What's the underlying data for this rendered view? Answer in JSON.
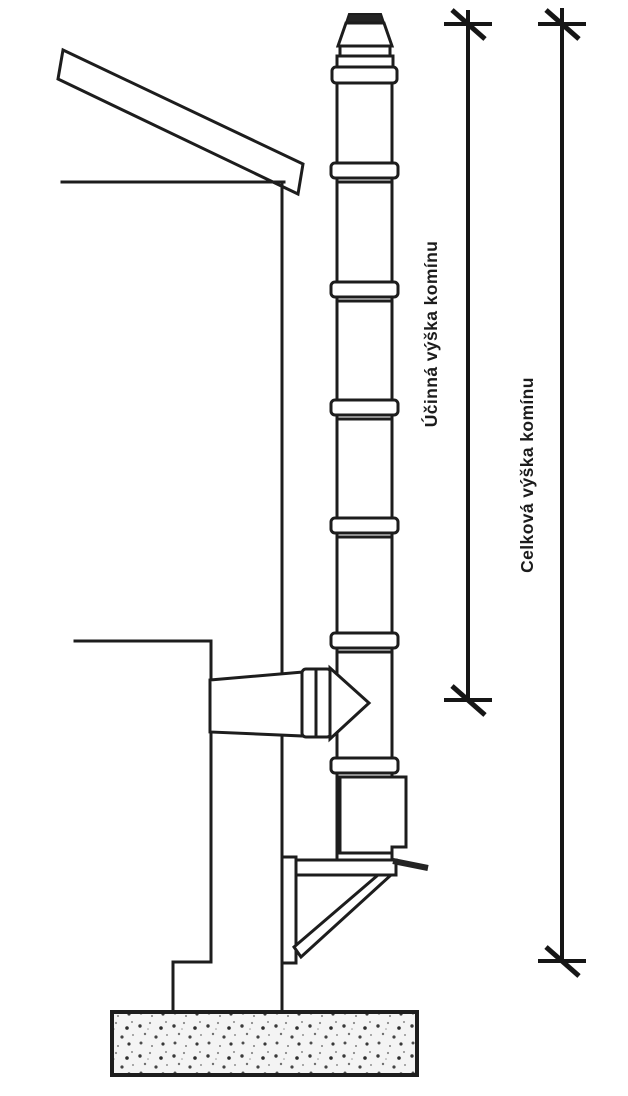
{
  "diagram": {
    "dimension_labels": {
      "effective_height": "Účinná výška komínu",
      "total_height": "Celková výška komínu"
    },
    "colors": {
      "background": "#ffffff",
      "line": "#1d1d1d",
      "cap_fill": "#242424"
    }
  }
}
